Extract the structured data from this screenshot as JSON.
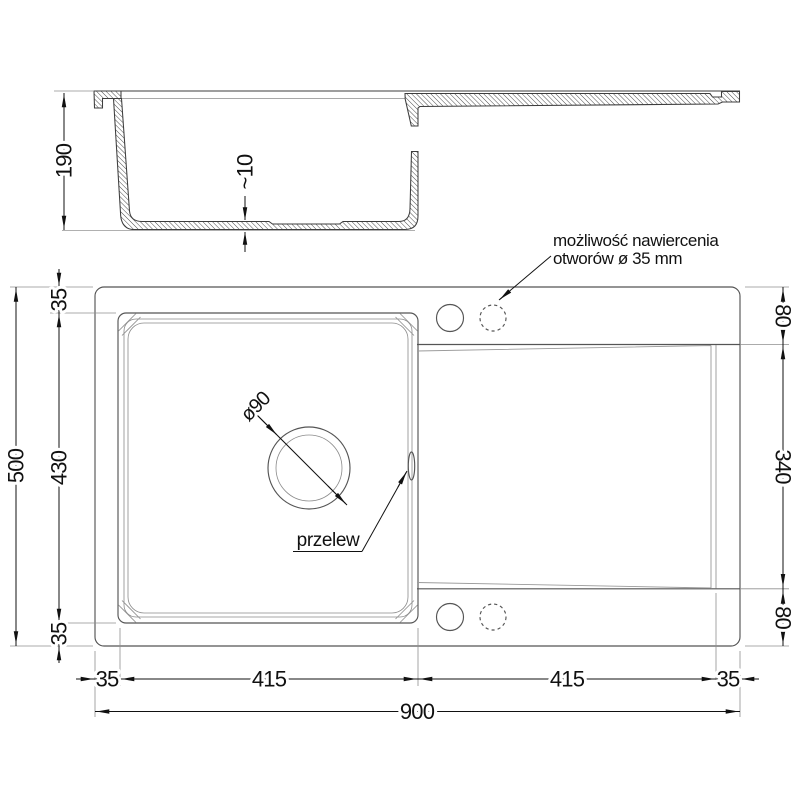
{
  "drawing": {
    "annotations": {
      "drill_note_line1": "możliwość nawiercenia",
      "drill_note_line2": "otworów ø 35 mm",
      "overflow_label": "przelew",
      "drain_diameter_label": "ø90"
    },
    "section_dims": {
      "total_height": "190",
      "bottom_thickness": "~10"
    },
    "plan_dims": {
      "total_width": "900",
      "total_depth": "500",
      "bowl_width": "415",
      "drainer_width": "415",
      "bowl_depth": "430",
      "edge_left": "35",
      "edge_right": "35",
      "edge_top": "35",
      "edge_bottom": "35",
      "deck_top": "80",
      "deck_bottom": "80",
      "drainer_depth": "340"
    }
  }
}
